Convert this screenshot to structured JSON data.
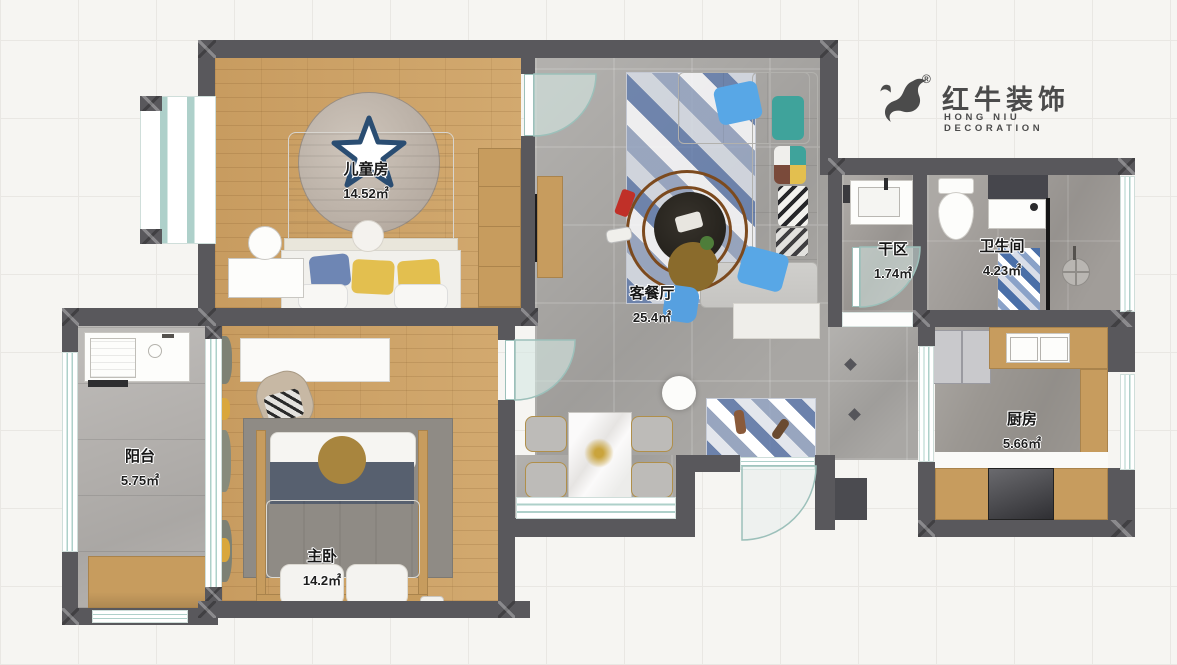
{
  "logo": {
    "brand_cn": "红牛装饰",
    "brand_en": "HONG NIU DECORATION",
    "registered_mark": "®",
    "icon": "bull-icon",
    "color": "#4b4b4b"
  },
  "rooms": [
    {
      "id": "children",
      "name": "儿童房",
      "area": "14.52㎡"
    },
    {
      "id": "living_dining",
      "name": "客餐厅",
      "area": "25.4㎡"
    },
    {
      "id": "dry_area",
      "name": "干区",
      "area": "1.74㎡"
    },
    {
      "id": "bathroom",
      "name": "卫生间",
      "area": "4.23㎡"
    },
    {
      "id": "balcony",
      "name": "阳台",
      "area": "5.75㎡"
    },
    {
      "id": "master_bedroom",
      "name": "主卧",
      "area": "14.2㎡"
    },
    {
      "id": "kitchen",
      "name": "厨房",
      "area": "5.66㎡"
    }
  ],
  "colors": {
    "wall": "#59585c",
    "wood_floor": "#cba268",
    "tile_floor": "#a9a7a4",
    "window_line": "#aed0ca",
    "accent_blue": "#58a7e6",
    "accent_yellow": "#e3bf4f",
    "logo_gray": "#4b4b4b"
  }
}
